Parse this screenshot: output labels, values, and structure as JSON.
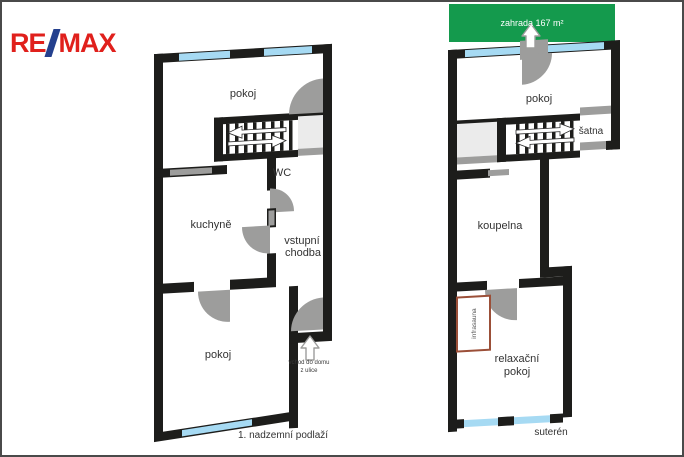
{
  "logo": {
    "re": "RE",
    "slash": "/",
    "max": "MAX"
  },
  "garden": {
    "label": "zahrada 167 m²"
  },
  "floor1": {
    "caption": "1. nadzemní podlaží",
    "room_top": "pokoj",
    "wc": "WC",
    "kitchen": "kuchyně",
    "hall_line1": "vstupní",
    "hall_line2": "chodba",
    "room_bottom": "pokoj",
    "entrance_line1": "vchod do domu",
    "entrance_line2": "z ulice"
  },
  "basement": {
    "caption": "suterén",
    "room": "pokoj",
    "wardrobe": "šatna",
    "bathroom": "koupelna",
    "relax_line1": "relaxační",
    "relax_line2": "pokoj",
    "sauna": "infrasauna"
  },
  "colors": {
    "wall": "#1d1d1b",
    "window": "#a6daf3",
    "door_gray": "#9d9d9c",
    "corridor": "#ebebeb",
    "garden_green": "#149a4d",
    "sauna_border": "#9b4f38",
    "logo_red": "#e0201c",
    "logo_blue": "#24408e"
  }
}
